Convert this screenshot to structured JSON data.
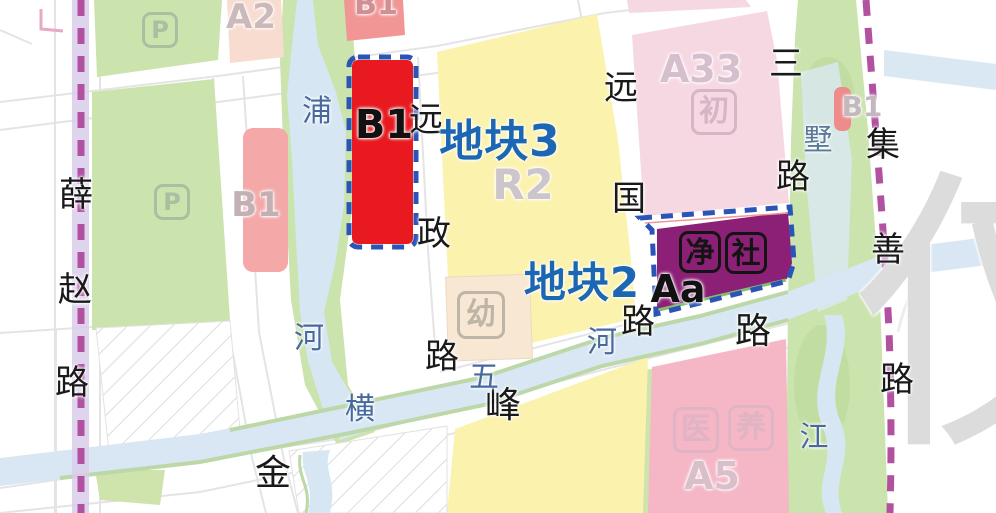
{
  "map": {
    "colors": {
      "plot_red": "#e8191f",
      "plot_purple": "#8c2077",
      "dash_blue": "#2a55b7",
      "dash_magenta": "#b351a1",
      "title_blue": "#1c67b4",
      "water_text": "#48699f",
      "road_text": "#191919",
      "yellow_parcel": "#fbf2ae",
      "green_parcel": "#cbe3ad",
      "river_fill": "#d8e7f3"
    },
    "plot_titles": [
      {
        "name": "plot3-title",
        "text": "地块3",
        "x": 500,
        "y": 142,
        "size": 44,
        "color": "#1c67b4"
      },
      {
        "name": "plot2-title",
        "text": "地块2",
        "x": 582,
        "y": 283,
        "size": 42,
        "color": "#1c67b4"
      }
    ],
    "roads": [
      {
        "name": "xuezhao-road",
        "label": "薛赵路",
        "size": 34,
        "chars": [
          {
            "c": "薛",
            "x": 76,
            "y": 195
          },
          {
            "c": "赵",
            "x": 75,
            "y": 290
          },
          {
            "c": "路",
            "x": 72,
            "y": 383
          }
        ]
      },
      {
        "name": "yuanzheng-road",
        "label": "远政路",
        "size": 34,
        "chars": [
          {
            "c": "远",
            "x": 426,
            "y": 120
          },
          {
            "c": "政",
            "x": 434,
            "y": 234
          },
          {
            "c": "路",
            "x": 442,
            "y": 357
          }
        ]
      },
      {
        "name": "yuanguo-road",
        "label": "远国路",
        "size": 34,
        "chars": [
          {
            "c": "远",
            "x": 621,
            "y": 88
          },
          {
            "c": "国",
            "x": 629,
            "y": 199
          },
          {
            "c": "路",
            "x": 638,
            "y": 322
          }
        ]
      },
      {
        "name": "san-road",
        "label": "三路",
        "size": 34,
        "chars": [
          {
            "c": "三",
            "x": 786,
            "y": 64
          },
          {
            "c": "路",
            "x": 793,
            "y": 177
          }
        ]
      },
      {
        "name": "jishan-road",
        "label": "集善路",
        "size": 34,
        "chars": [
          {
            "c": "集",
            "x": 883,
            "y": 145
          },
          {
            "c": "善",
            "x": 888,
            "y": 250
          },
          {
            "c": "路",
            "x": 897,
            "y": 380
          }
        ]
      },
      {
        "name": "jinfeng-road",
        "label": "金峰路",
        "size": 36,
        "chars": [
          {
            "c": "金",
            "x": 273,
            "y": 474
          },
          {
            "c": "峰",
            "x": 503,
            "y": 406
          },
          {
            "c": "路",
            "x": 753,
            "y": 332
          }
        ]
      }
    ],
    "waters": [
      {
        "name": "pu-he-river",
        "label": "浦河",
        "size": 30,
        "color": "#48699f",
        "chars": [
          {
            "c": "浦",
            "x": 317,
            "y": 112
          },
          {
            "c": "河",
            "x": 309,
            "y": 339
          }
        ]
      },
      {
        "name": "hengwu-he-river",
        "label": "横五河",
        "size": 30,
        "color": "#48699f",
        "chars": [
          {
            "c": "横",
            "x": 360,
            "y": 410
          },
          {
            "c": "五",
            "x": 484,
            "y": 378
          },
          {
            "c": "河",
            "x": 602,
            "y": 343
          }
        ]
      },
      {
        "name": "shu-water",
        "label": "墅",
        "size": 29,
        "color": "#5b7a9a",
        "chars": [
          {
            "c": "墅",
            "x": 818,
            "y": 140
          }
        ]
      },
      {
        "name": "jiang-water",
        "label": "江",
        "size": 29,
        "color": "#48699f",
        "chars": [
          {
            "c": "江",
            "x": 814,
            "y": 437
          }
        ]
      }
    ],
    "parcel_codes": [
      {
        "name": "plot-b1-red-code",
        "text": "B1",
        "x": 384,
        "y": 125,
        "size": 40,
        "color": "#111111",
        "bold": true
      },
      {
        "name": "plot-aa-code",
        "text": "Aa",
        "x": 678,
        "y": 289,
        "size": 38,
        "color": "#111111",
        "bold": true
      },
      {
        "name": "parcel-a2-code",
        "text": "A2",
        "x": 251,
        "y": 17,
        "size": 34,
        "color": "#cbb9bc",
        "bold": false
      },
      {
        "name": "parcel-b1-west-code",
        "text": "B1",
        "x": 256,
        "y": 205,
        "size": 34,
        "color": "#c2b0b4",
        "bold": false
      },
      {
        "name": "parcel-b1-north-code",
        "text": "B1",
        "x": 376,
        "y": 5,
        "size": 30,
        "color": "#cf8f93",
        "bold": false
      },
      {
        "name": "parcel-a33-code",
        "text": "A33",
        "x": 701,
        "y": 69,
        "size": 38,
        "color": "#d6bfcd",
        "bold": false
      },
      {
        "name": "parcel-r2-code",
        "text": "R2",
        "x": 523,
        "y": 185,
        "size": 42,
        "color": "#cdc5cc",
        "bold": false
      },
      {
        "name": "parcel-b1-east-code",
        "text": "B1",
        "x": 862,
        "y": 107,
        "size": 28,
        "color": "#c3b8bf",
        "bold": false
      },
      {
        "name": "parcel-a5-code",
        "text": "A5",
        "x": 712,
        "y": 476,
        "size": 38,
        "color": "#d8bfca",
        "bold": false
      }
    ],
    "icons": [
      {
        "name": "parking-icon",
        "glyph": "P",
        "x": 160,
        "y": 30,
        "box": 36,
        "font": 24,
        "color": "#a9bfa2"
      },
      {
        "name": "parking-icon",
        "glyph": "P",
        "x": 172,
        "y": 202,
        "box": 36,
        "font": 24,
        "color": "#a9bfa2"
      },
      {
        "name": "kindergarten-icon",
        "glyph": "幼",
        "x": 481,
        "y": 315,
        "box": 48,
        "font": 30,
        "color": "#bdb5a8"
      },
      {
        "name": "junior-school-icon",
        "glyph": "初",
        "x": 714,
        "y": 112,
        "box": 46,
        "font": 30,
        "color": "#d6b6c6"
      },
      {
        "name": "sewage-icon",
        "glyph": "净",
        "x": 700,
        "y": 252,
        "box": 42,
        "font": 29,
        "color": "#141414"
      },
      {
        "name": "community-icon",
        "glyph": "社",
        "x": 746,
        "y": 253,
        "box": 42,
        "font": 29,
        "color": "#141414"
      },
      {
        "name": "medical-icon",
        "glyph": "医",
        "x": 696,
        "y": 430,
        "box": 46,
        "font": 30,
        "color": "#dfb4c4"
      },
      {
        "name": "eldercare-icon",
        "glyph": "养",
        "x": 751,
        "y": 428,
        "box": 46,
        "font": 30,
        "color": "#dfb4c4"
      }
    ],
    "watermark": {
      "text": "仅",
      "x": 1002,
      "y": 318,
      "size": 300,
      "color": "rgba(140,140,140,0.30)"
    }
  }
}
